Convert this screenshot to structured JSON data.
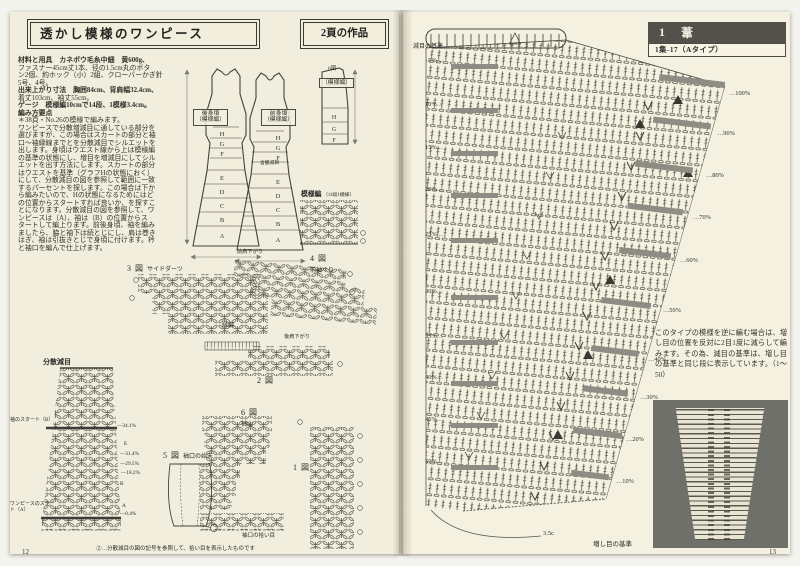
{
  "left": {
    "title": "透かし模様のワンピース",
    "title_right": "2頁の作品",
    "page_number": "12",
    "body": [
      "材料と用具　カネボウ毛糸中細　黄600g、",
      "ファスナー45cm丈1本、径の1.5cm丸のボタ",
      "ン2個、約ホック（小）2組、クローバーかぎ針",
      "5号、4号。",
      "出来上がり寸法　胸囲84cm、背肩幅32.4cm、",
      "着丈103cm、袖丈55cm。",
      "ゲージ　模様編10cmで14段、1模様3.4cm。",
      "編み方要点",
      "＊38頁・No.26の模様で編みます。",
      "ワンピースで分散増減目に通している部分を",
      "選びますが、この場合はスカートの部分と袖",
      "口〜袖縁線までとを分散減目でシルエットを",
      "出します。身頃はウエスト線から上は模様編",
      "の基準の状態にし、増目を増減目にしてシル",
      "エットを出す方法にします。スカートの部分",
      "はウエストを基準（グラフHの状態におく）",
      "にして、分散減目の図を参照して範囲に一致",
      "するパーセントを探します。この場合は下か",
      "ら編みたいので、Hの状態になるためにはど",
      "の位置からスタートすれば良いか、を探すこ",
      "とになります。分散減目の図を参照して、ワ",
      "ンピースは（A）、袖は（B）の位置からス",
      "タートして編上ります。前後身頃、袖を編み",
      "ましたら、脇と袖下は続とじにし、肩は巻き",
      "はぎ、袖は引抜きとじで身頃に付けます。衿",
      "と袖口を編んで仕上げます。"
    ],
    "labels": {
      "back": "後身頃",
      "back_sub": "（模様編）",
      "front": "前身頃",
      "front_sub": "（模様編）",
      "sleeve_sub": "（模様編）",
      "fig6_top": "6図",
      "swatch": "模様編",
      "swatch_note": "（14段1模様）",
      "fig3": "3 図",
      "fig3_name": "サイドダーツ",
      "fig4": "4 図",
      "fig4_name": "前袖ぐり",
      "fig4_note": "前肩下がり",
      "fig2": "2 図",
      "edge": "縁編",
      "back_shoulder": "後肩下がり",
      "fig6": "6 図",
      "fig6_name": "袖山",
      "fig1": "1 図",
      "fig5": "5 図",
      "fig5_name": "袖口の始末",
      "pickup": "袖口の拾い目",
      "dispersal": "分散減目",
      "start_b": "袖のスタート（B）",
      "start_a": "ワンピースのスタート（A）",
      "side_note": "含脇減目",
      "footnote": "②…分散減目の図の記号を参照して、拾い目を表示したものです"
    },
    "sections": [
      "H",
      "G",
      "F",
      "E",
      "D",
      "C",
      "B",
      "A"
    ],
    "sleeve_sections": [
      "H",
      "G",
      "F"
    ],
    "dec": [
      "—34.1%",
      "E",
      "—31.4%",
      "—29.5%",
      "—18.2%",
      "B",
      "A",
      "—0.4%"
    ]
  },
  "right": {
    "page_number": "13",
    "header": {
      "num": "1",
      "title": "葦",
      "subtitle": "1集-17（Aタイプ）"
    },
    "axis_label": "減目の基準",
    "lp": [
      "5%…",
      "10%…",
      "15%…",
      "20%…",
      "25%…",
      "30%…",
      "35%…",
      "40%…",
      "45%…",
      "50%…"
    ],
    "rp": [
      "…100%",
      "…90%",
      "…80%",
      "…70%",
      "…60%",
      "…50%",
      "…40%",
      "…30%",
      "…20%",
      "…10%"
    ],
    "bottom_measure": "3.5c",
    "bottom_label": "増し目の基準",
    "note": "このタイプの模様を逆に編む場合は、増し目の位置を反対に2目1度に減らして編みます。その為、減目の基準は、増し目の基準と同じ段に表示しています。（1〜50）"
  },
  "colors": {
    "paper": "#f1eedd",
    "ink": "#45433c",
    "header_bg": "#53514b",
    "marker_gray": "#8d8d84"
  }
}
